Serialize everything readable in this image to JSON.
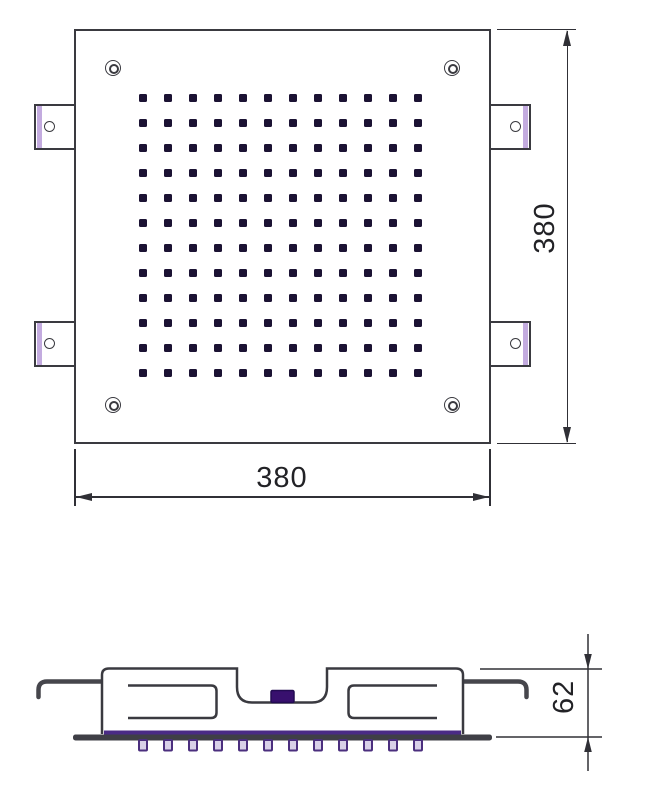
{
  "drawing": {
    "type": "technical-drawing",
    "subject": "square ceiling shower head",
    "top_view": {
      "nozzle_rows": 12,
      "nozzle_cols": 12,
      "nozzle_grid_start_x": 143,
      "nozzle_grid_start_y": 98,
      "nozzle_grid_step": 25,
      "corner_screw_count": 4,
      "mounting_tab_count": 4,
      "width_dim": "380",
      "height_dim": "380"
    },
    "side_view": {
      "depth_dim": "62",
      "nozzle_teeth": 12,
      "teeth_start_x": 143,
      "teeth_step": 25
    },
    "colors": {
      "line": "#3a3a40",
      "dim_line": "#303036",
      "nozzle_dark": "#1b1233",
      "tab_stripe_lavender": "#c3abdf",
      "gasket_purple": "#4a2b85",
      "inlet_indigo": "#38106e",
      "tooth_fill": "#d8d0e8",
      "tooth_border": "#4b2f7e"
    }
  }
}
